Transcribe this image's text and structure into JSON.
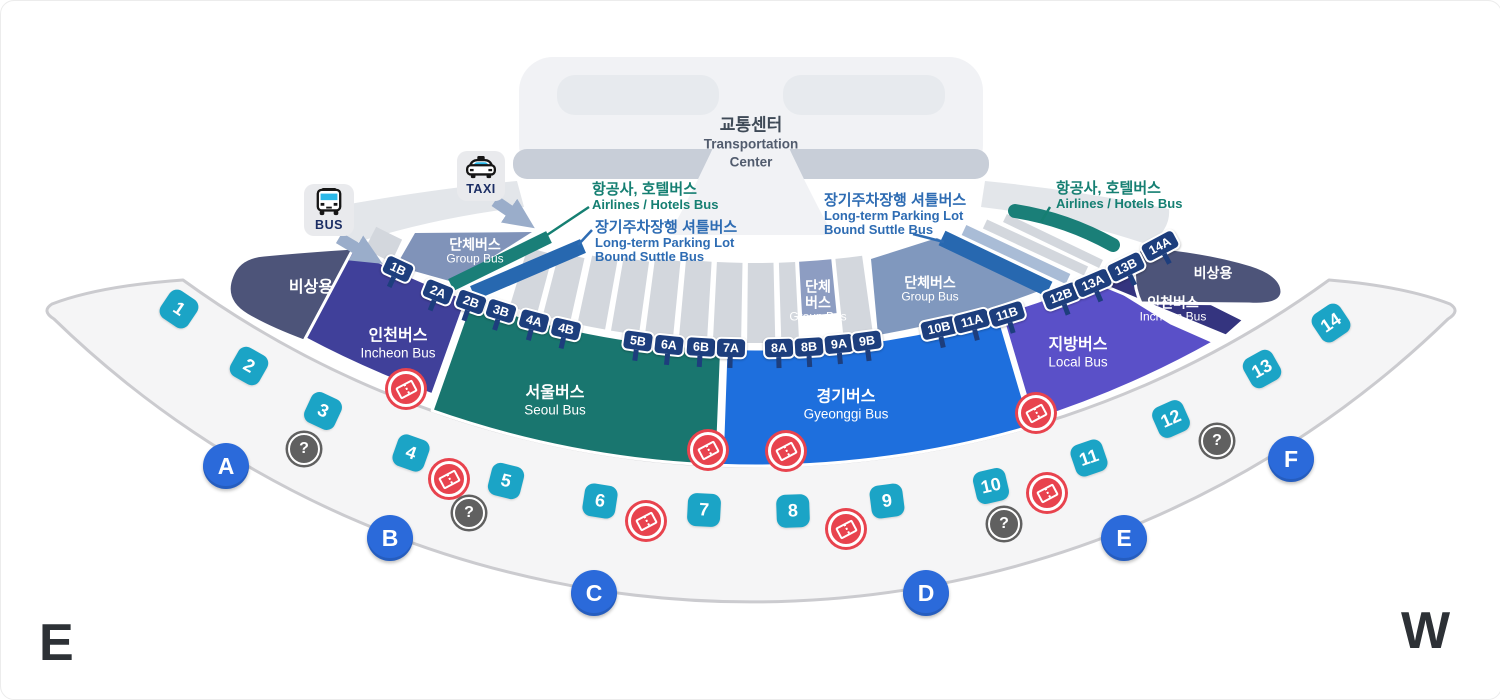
{
  "page": {
    "east": "E",
    "west": "W"
  },
  "building": {
    "kor": "교통센터",
    "eng_line1": "Transportation",
    "eng_line2": "Center"
  },
  "access_icons": {
    "bus": "BUS",
    "taxi": "TAXI"
  },
  "callouts": {
    "airlines_left": {
      "kor": "항공사, 호텔버스",
      "eng": "Airlines / Hotels Bus"
    },
    "parking_left": {
      "kor": "장기주차장행 셔틀버스",
      "eng_line1": "Long-term Parking Lot",
      "eng_line2": "Bound Suttle Bus"
    },
    "parking_right": {
      "kor": "장기주차장행 셔틀버스",
      "eng_line1": "Long-term Parking Lot",
      "eng_line2": "Bound Suttle Bus"
    },
    "airlines_right": {
      "kor": "항공사, 호텔버스",
      "eng": "Airlines / Hotels Bus"
    }
  },
  "zones": {
    "emergency_left": {
      "kor": "비상용"
    },
    "incheon_left": {
      "kor": "인천버스",
      "eng": "Incheon Bus"
    },
    "seoul": {
      "kor": "서울버스",
      "eng": "Seoul Bus"
    },
    "gyeonggi": {
      "kor": "경기버스",
      "eng": "Gyeonggi Bus"
    },
    "local": {
      "kor": "지방버스",
      "eng": "Local Bus"
    },
    "incheon_right": {
      "kor": "인천버스",
      "eng": "Incheon Bus"
    },
    "emergency_right": {
      "kor": "비상용"
    },
    "group_left": {
      "kor": "단체버스",
      "eng": "Group Bus"
    },
    "group_mid": {
      "kor_line1": "단체",
      "kor_line2": "버스",
      "eng": "Group Bus"
    },
    "group_right": {
      "kor": "단체버스",
      "eng": "Group Bus"
    }
  },
  "stops": [
    "1B",
    "2A",
    "2B",
    "3B",
    "4A",
    "4B",
    "5B",
    "6A",
    "6B",
    "7A",
    "8A",
    "8B",
    "9A",
    "9B",
    "10B",
    "11A",
    "11B",
    "12B",
    "13A",
    "13B",
    "14A"
  ],
  "doors": [
    "1",
    "2",
    "3",
    "4",
    "5",
    "6",
    "7",
    "8",
    "9",
    "10",
    "11",
    "12",
    "13",
    "14"
  ],
  "gates": [
    "A",
    "B",
    "C",
    "D",
    "E",
    "F"
  ],
  "icons": {
    "question_glyph": "?"
  },
  "colors": {
    "zone_emergency": "#4d5479",
    "zone_incheon_left": "#40409a",
    "zone_seoul": "#19766f",
    "zone_gyeonggi": "#1e6fdd",
    "zone_local": "#5a50c8",
    "zone_incheon_right": "#34347f",
    "strip_group_left": "#8093b9",
    "strip_group_mid": "#8d9dc2",
    "strip_group_right": "#8098be",
    "strip_gray": "#d3d7dd",
    "strip_teal": "#1a7f78",
    "strip_blue": "#2768b0",
    "strip_light_blue": "#a9bcd6",
    "stop_tag": "#1d3e7d",
    "door_number": "#1ba4c6",
    "gate_letter": "#2b6ada",
    "ticket_icon": "#e8434e",
    "question_icon": "#606060",
    "callout_teal": "#157f72",
    "callout_blue": "#2e6cb3",
    "walkway_fill": "#f5f5f6",
    "walkway_border": "#cbcbcf"
  }
}
